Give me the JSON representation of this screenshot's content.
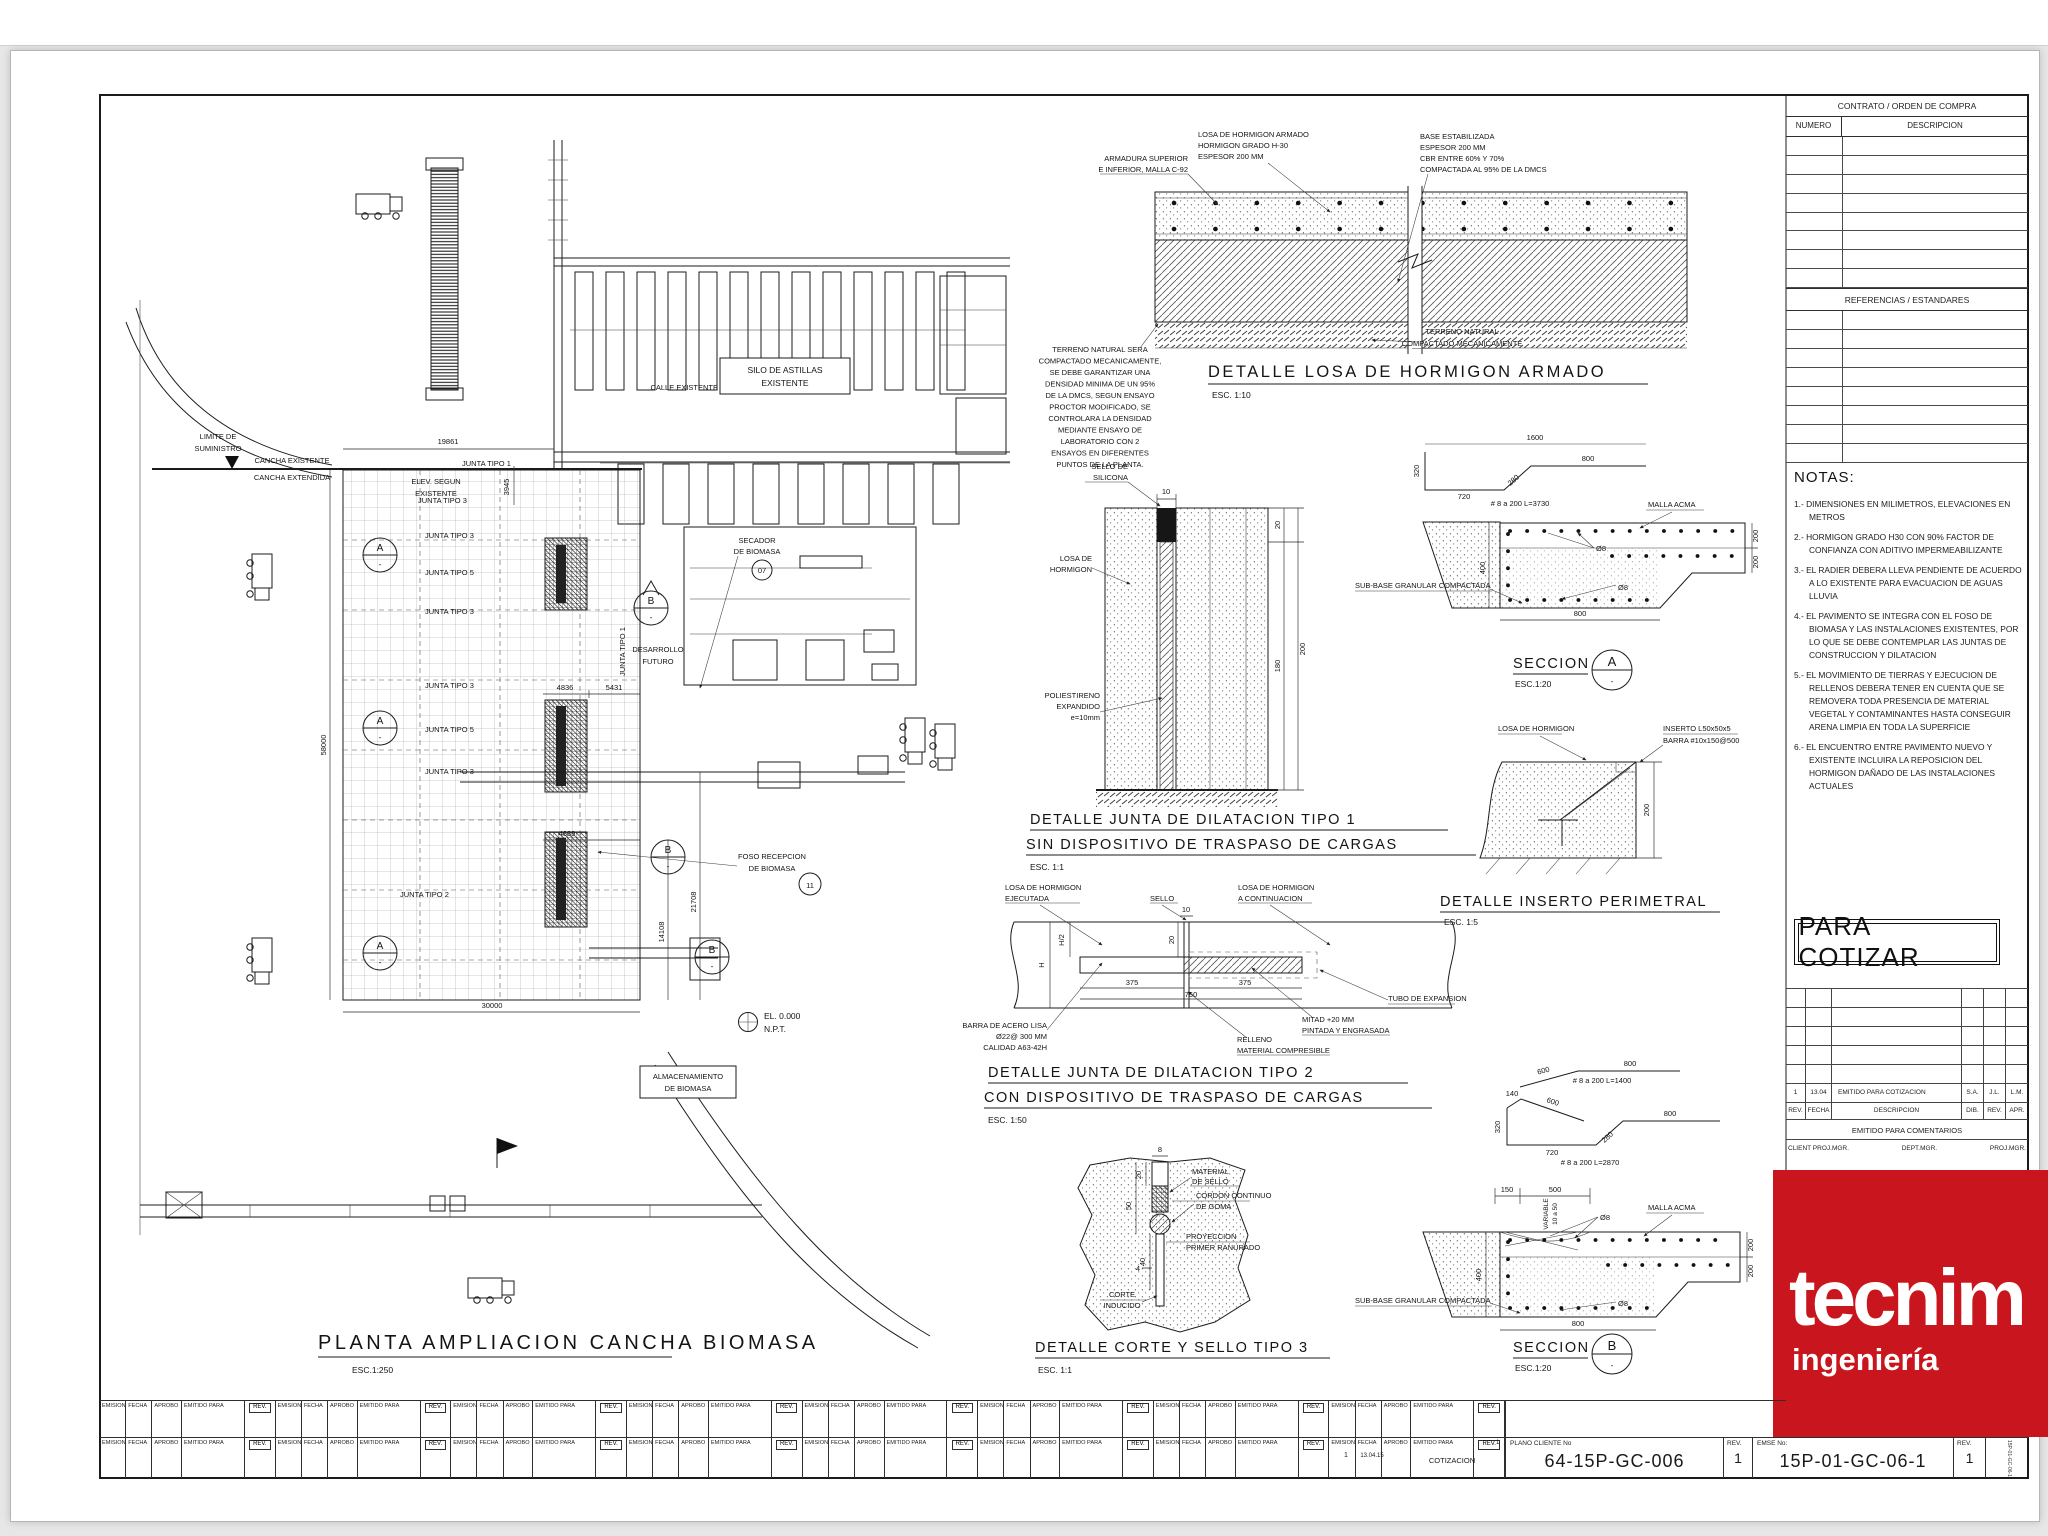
{
  "accent_red": "#c9151d",
  "sym": {
    "dash": "-"
  },
  "contract": {
    "header": "CONTRATO / ORDEN DE COMPRA",
    "numero": "NUMERO",
    "descripcion": "DESCRIPCION"
  },
  "references": {
    "header": "REFERENCIAS / ESTANDARES"
  },
  "notas": {
    "title": "NOTAS:",
    "items": [
      "1.- DIMENSIONES EN MILIMETROS, ELEVACIONES EN METROS",
      "2.- HORMIGON GRADO H30 CON 90% FACTOR DE CONFIANZA CON ADITIVO IMPERMEABILIZANTE",
      "3.- EL RADIER DEBERA LLEVA PENDIENTE DE ACUERDO A LO EXISTENTE PARA EVACUACION DE AGUAS LLUVIA",
      "4.- EL PAVIMENTO SE INTEGRA CON EL FOSO DE BIOMASA Y LAS INSTALACIONES EXISTENTES, POR LO QUE SE DEBE CONTEMPLAR LAS JUNTAS DE CONSTRUCCION Y DILATACION",
      "5.- EL MOVIMIENTO DE TIERRAS Y EJECUCION DE RELLENOS DEBERA TENER EN CUENTA QUE SE REMOVERA TODA PRESENCIA DE MATERIAL VEGETAL Y CONTAMINANTES HASTA CONSEGUIR ARENA LIMPIA EN TODA LA SUPERFICIE",
      "6.- EL ENCUENTRO ENTRE PAVIMENTO NUEVO Y EXISTENTE INCLUIRA LA REPOSICION DEL HORMIGON DAÑADO DE LAS INSTALACIONES ACTUALES"
    ]
  },
  "stamp": {
    "text": "PARA COTIZAR"
  },
  "revtable": {
    "rev1": "1",
    "fecha1": "13.04",
    "desc1": "EMITIDO PARA COTIZACION",
    "dib1": "S.A.",
    "rev21": "J.L.",
    "apr1": "L.M.",
    "h_rev": "REV.",
    "h_fecha": "FECHA",
    "h_desc": "DESCRIPCION",
    "h_dib": "DIB.",
    "h_rev2": "REV.",
    "h_apr": "APR.",
    "emitido": "EMITIDO PARA COMENTARIOS",
    "client": "CLIENT PROJ.MGR.",
    "dept": "DEPT.MGR.",
    "proj": "PROJ.MGR."
  },
  "logo": {
    "brand": "tecnim",
    "tagline": "ingeniería",
    "bg": "#c9151d"
  },
  "footer": {
    "emision": "EMISION",
    "fecha": "FECHA",
    "aprobo": "APROBO",
    "emitido": "EMITIDO PARA",
    "rev": "REV.",
    "v_emision": "1",
    "v_fecha": "13.04.15",
    "v_emitido": "COTIZACION",
    "v_rev": "1",
    "plano_label": "PLANO  CLIENTE  No",
    "plano": "64-15P-GC-006",
    "plano_rev_label": "REV.",
    "plano_rev": "1",
    "emse_label": "EMSE  No:",
    "emse": "15P-01-GC-06-1",
    "emse_rev_label": "REV.",
    "emse_rev": "1",
    "edge": "15P-01-GC-06-1"
  },
  "plan": {
    "title": "PLANTA  AMPLIACION  CANCHA  BIOMASA",
    "scale": "ESC.1:250",
    "limite1": "LIMITE DE",
    "limite2": "SUMINISTRO",
    "cancha1": "CANCHA EXISTENTE",
    "cancha2": "CANCHA EXTENDIDA",
    "calle": "CALLE EXISTENTE",
    "silo1": "SILO DE ASTILLAS",
    "silo2": "EXISTENTE",
    "secador1": "SECADOR",
    "secador2": "DE BIOMASA",
    "secador_no": "07",
    "desarrollo1": "DESARROLLO",
    "desarrollo2": "FUTURO",
    "elev1": "ELEV. SEGUN",
    "elev2": "EXISTENTE",
    "foso1": "FOSO RECEPCION",
    "foso2": "DE BIOMASA",
    "foso_no": "11",
    "alm1": "ALMACENAMIENTO",
    "alm2": "DE BIOMASA",
    "el1": "EL. 0.000",
    "el2": "N.P.T.",
    "j1": "JUNTA TIPO 1",
    "j2": "JUNTA TIPO 3",
    "j3": "JUNTA TIPO 3",
    "j4": "JUNTA TIPO 5",
    "j5": "JUNTA TIPO 3",
    "j6": "JUNTA TIPO 3",
    "j7": "JUNTA TIPO 5",
    "j8": "JUNTA TIPO 3",
    "j9": "JUNTA TIPO 2",
    "jv": "JUNTA TIPO 1",
    "d19861": "19861",
    "d3945": "3945",
    "d58000": "58000",
    "d30000": "30000",
    "d21708": "21708",
    "d14108": "14108",
    "d4836": "4836",
    "d5431": "5431",
    "d4839": "4839",
    "mA": "A",
    "mB": "B"
  },
  "losa": {
    "t": "DETALLE  LOSA  DE  HORMIGON  ARMADO",
    "s": "ESC.  1:10",
    "arm1": "ARMADURA SUPERIOR",
    "arm2": "E INFERIOR, MALLA C-92",
    "l1": "LOSA DE HORMIGON ARMADO",
    "l2": "HORMIGON GRADO H-30",
    "l3": "ESPESOR 200 MM",
    "b1": "BASE ESTABILIZADA",
    "b2": "ESPESOR 200 MM",
    "b3": "CBR ENTRE 60% Y 70%",
    "b4": "COMPACTADA AL 95% DE LA DMCS",
    "t1": "TERRENO NATURAL",
    "t2": "COMPACTADO MECANICAMENTE",
    "n1": "TERRENO NATURAL SERA",
    "n2": "COMPACTADO MECANICAMENTE,",
    "n3": "SE DEBE GARANTIZAR UNA",
    "n4": "DENSIDAD MINIMA DE UN 95%",
    "n5": "DE LA DMCS, SEGUN ENSAYO",
    "n6": "PROCTOR MODIFICADO, SE",
    "n7": "CONTROLARA LA DENSIDAD",
    "n8": "MEDIANTE ENSAYO DE",
    "n9": "LABORATORIO CON 2",
    "n10": "ENSAYOS EN DIFERENTES",
    "n11": "PUNTOS DE LA PLANTA."
  },
  "tipo1": {
    "t1": "DETALLE  JUNTA  DE  DILATACION  TIPO  1",
    "t2": "SIN  DISPOSITIVO  DE  TRASPASO  DE  CARGAS",
    "s": "ESC.  1:1",
    "sello1": "SELLO DE",
    "sello2": "SILICONA",
    "losa1": "LOSA DE",
    "losa2": "HORMIGON",
    "poli1": "POLIESTIRENO",
    "poli2": "EXPANDIDO",
    "poli3": "e=10mm",
    "d10": "10",
    "d20": "20",
    "d180": "180",
    "d200": "200"
  },
  "tipo2": {
    "t1": "DETALLE  JUNTA  DE  DILATACION  TIPO  2",
    "t2": "CON  DISPOSITIVO  DE  TRASPASO  DE  CARGAS",
    "s": "ESC.  1:50",
    "le1": "LOSA DE HORMIGON",
    "le2": "EJECUTADA",
    "sello": "SELLO",
    "lc1": "LOSA DE HORMIGON",
    "lc2": "A CONTINUACION",
    "tubo": "TUBO DE EXPANSION",
    "m1": "MITAD +20 MM",
    "m2": "PINTADA Y ENGRASADA",
    "r1": "RELLENO",
    "r2": "MATERIAL COMPRESIBLE",
    "ba1": "BARRA DE ACERO LISA",
    "ba2": "Ø22@ 300 MM",
    "ba3": "CALIDAD A63-42H",
    "d10": "10",
    "d20": "20",
    "dh2": "H/2",
    "dh": "H",
    "d375a": "375",
    "d375b": "375",
    "d750": "750"
  },
  "tipo3": {
    "t": "DETALLE  CORTE  Y  SELLO  TIPO  3",
    "s": "ESC.  1:1",
    "ma1": "MATERIAL",
    "ma2": "DE SELLO",
    "co1": "CORDON CONTINUO",
    "co2": "DE GOMA",
    "pr1": "PROYECCION",
    "pr2": "PRIMER RANURADO",
    "ci1": "CORTE",
    "ci2": "INDUCIDO",
    "d8": "8",
    "d20": "20",
    "d50": "50",
    "d40": "40",
    "d4": "4"
  },
  "secA": {
    "t": "SECCION",
    "s": "ESC.1:20",
    "m": "A",
    "malla": "MALLA ACMA",
    "f1": "Ø8",
    "f2": "Ø8",
    "sub": "SUB-BASE GRANULAR COMPACTADA",
    "d400": "400",
    "d800": "800",
    "d200a": "200",
    "d200b": "200",
    "r1600": "1600",
    "r320": "320",
    "r720": "720",
    "r280": "280",
    "r800": "800",
    "rspec": "# 8 a 200 L=3730"
  },
  "inserto": {
    "t": "DETALLE  INSERTO  PERIMETRAL",
    "s": "ESC.  1:5",
    "losa": "LOSA DE HORMIGON",
    "i1": "INSERTO L50x50x5",
    "i2": "BARRA #10x150@500",
    "d200": "200"
  },
  "secB": {
    "t": "SECCION",
    "s": "ESC.1:20",
    "m": "B",
    "malla": "MALLA ACMA",
    "f1": "Ø8",
    "f2": "Ø8",
    "sub": "SUB-BASE GRANULAR COMPACTADA",
    "d150": "150",
    "d500": "500",
    "var1": "VARIABLE",
    "var2": "10 a 50",
    "d400": "400",
    "d200a": "200",
    "d200b": "200",
    "d800": "800",
    "r1_600": "600",
    "r1_800": "800",
    "r1_spec": "# 8 a 200 L=1400",
    "r2_140": "140",
    "r2_600": "600",
    "r2_320": "320",
    "r2_720": "720",
    "r2_280": "280",
    "r2_800": "800",
    "r2_spec": "# 8 a 200 L=2870"
  }
}
